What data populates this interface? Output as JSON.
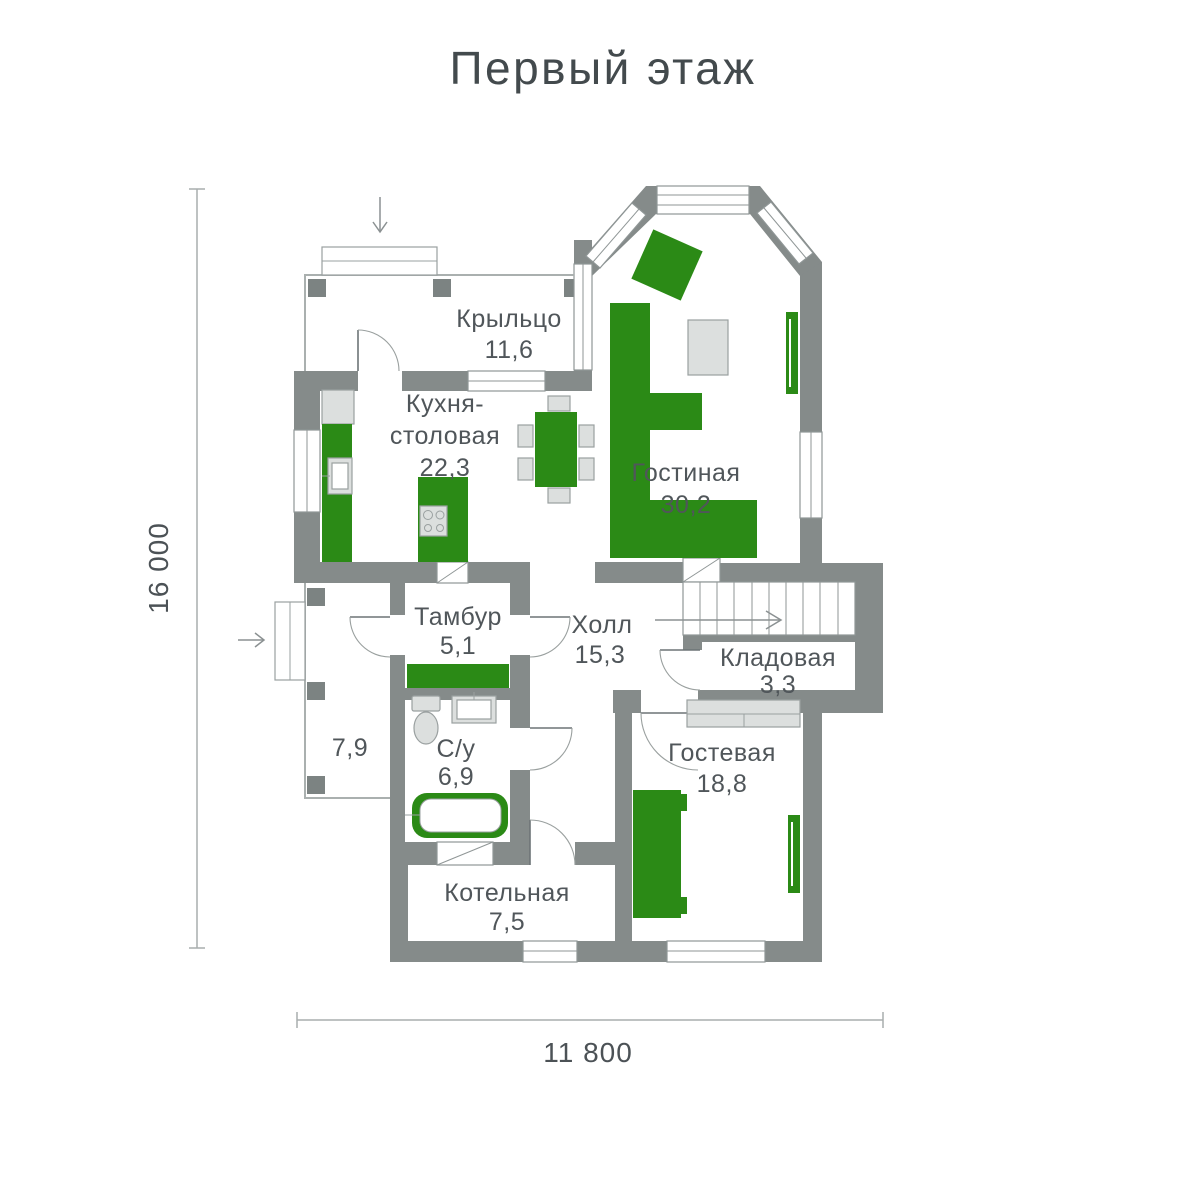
{
  "title": "Первый этаж",
  "floor_plan": {
    "rooms": {
      "porch": {
        "name": "Крыльцо",
        "area": "11,6"
      },
      "kitchen_dining": {
        "name_line1": "Кухня-",
        "name_line2": "столовая",
        "area": "22,3"
      },
      "living": {
        "name": "Гостиная",
        "area": "30,2"
      },
      "vestibule": {
        "name": "Тамбур",
        "area": "5,1"
      },
      "hall": {
        "name": "Холл",
        "area": "15,3"
      },
      "storage": {
        "name": "Кладовая",
        "area": "3,3"
      },
      "terrace": {
        "area": "7,9"
      },
      "bathroom": {
        "name": "С/у",
        "area": "6,9"
      },
      "guest": {
        "name": "Гостевая",
        "area": "18,8"
      },
      "boiler": {
        "name": "Котельная",
        "area": "7,5"
      }
    },
    "dimensions": {
      "vertical": "16 000",
      "horizontal": "11 800"
    }
  },
  "colors": {
    "wall_gray": "#858b8a",
    "accent_green": "#2b8a16",
    "furniture_gray": "#dcdfde",
    "label_text": "#50565a"
  }
}
